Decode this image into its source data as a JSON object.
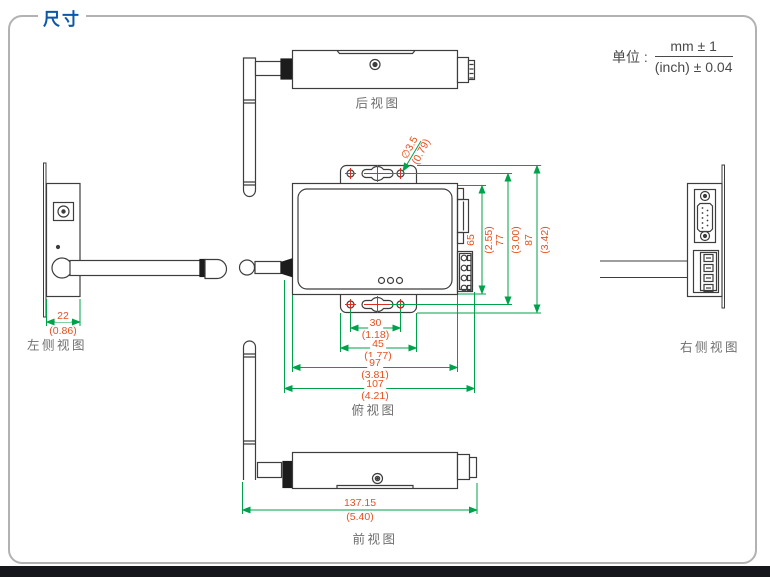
{
  "header": {
    "title": "尺寸"
  },
  "unit_note": {
    "label": "单位 :",
    "numerator": "mm ± 1",
    "denominator": "(inch) ± 0.04"
  },
  "views": {
    "rear_label": "后视图",
    "left_label": "左侧视图",
    "right_label": "右侧视图",
    "top_label": "俯视图",
    "front_label": "前视图"
  },
  "dimensions": {
    "side_width": {
      "mm": "22",
      "inch": "(0.86)"
    },
    "mounting_hole_diameter": {
      "mm": "∅3.5",
      "inch": "(0.79)"
    },
    "body_depth": {
      "mm": "65",
      "inch": "(2.55)"
    },
    "mounting_slot_span": {
      "mm": "77",
      "inch": "(3.00)"
    },
    "overall_depth": {
      "mm": "87",
      "inch": "(3.42)"
    },
    "mounting_hole_span": {
      "mm": "30",
      "inch": "(1.18)"
    },
    "mounting_tab_width": {
      "mm": "45",
      "inch": "(1.77)"
    },
    "body_width": {
      "mm": "97",
      "inch": "(3.81)"
    },
    "overall_width": {
      "mm": "107",
      "inch": "(4.21)"
    },
    "overall_length_with_antenna": {
      "mm": "137.15",
      "inch": "(5.40)"
    }
  },
  "colors": {
    "title_blue": "#0c58a8",
    "dimension_text_orange": "#e8501e",
    "dimension_line_green": "#00a14b",
    "center_mark_red": "#d93025",
    "drawing_line_gray": "#3d3d3d",
    "view_label_gray": "#6f6f6f",
    "frame_border_gray": "#b2b2b2",
    "footer_bar_dark": "#16161d"
  }
}
